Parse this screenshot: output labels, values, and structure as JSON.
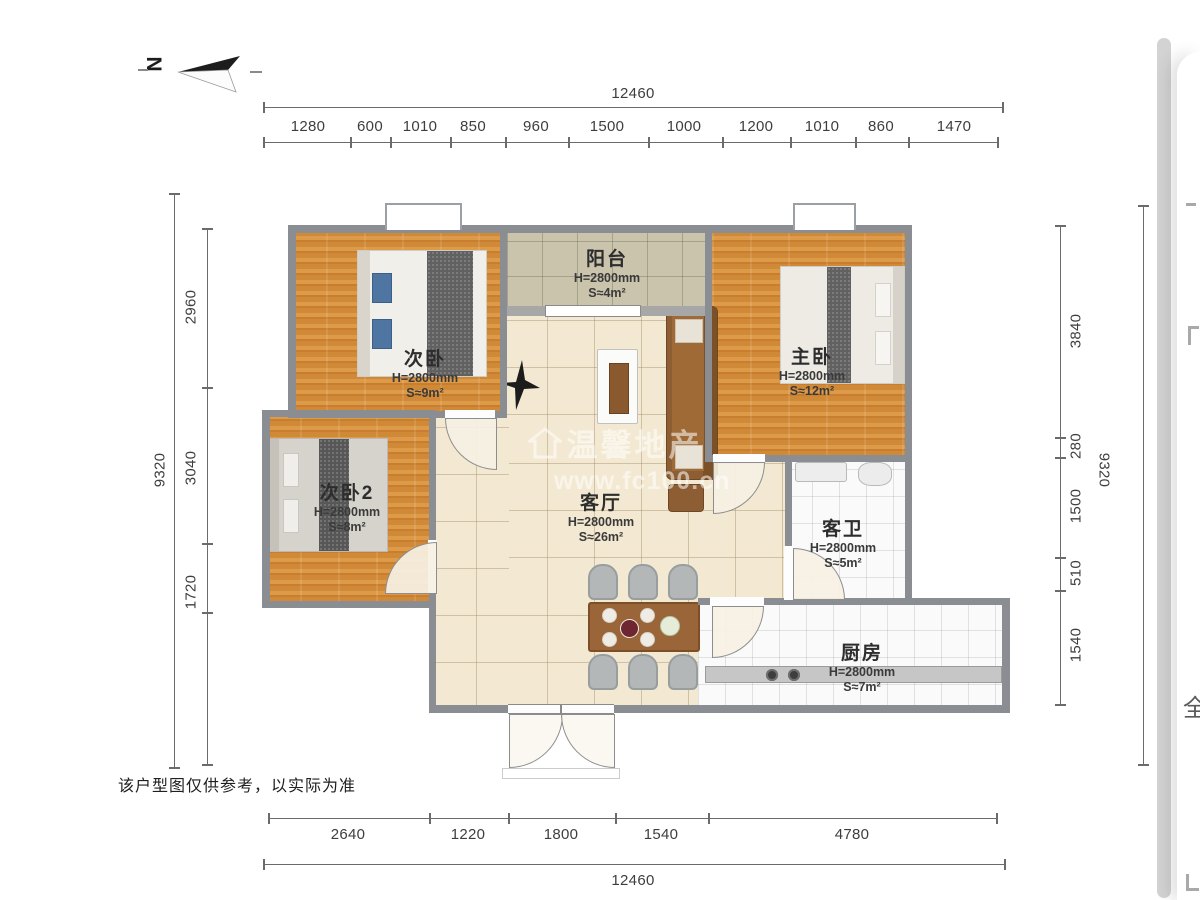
{
  "north": {
    "label": "N"
  },
  "dimensions": {
    "top": {
      "total": "12460",
      "segments": [
        "1280",
        "600",
        "1010",
        "850",
        "960",
        "1500",
        "1000",
        "1200",
        "1010",
        "860",
        "1470"
      ]
    },
    "bottom": {
      "total": "12460",
      "segments": [
        "2640",
        "1220",
        "1800",
        "1540",
        "4780"
      ]
    },
    "left": {
      "total": "9320",
      "segments": [
        "2960",
        "3040",
        "1720"
      ]
    },
    "right": {
      "total": "9320",
      "segments": [
        "3840",
        "280",
        "1500",
        "510",
        "1540"
      ]
    }
  },
  "rooms": [
    {
      "name": "阳台",
      "height": "H=2800mm",
      "area": "S≈4m²"
    },
    {
      "name": "次卧",
      "height": "H=2800mm",
      "area": "S≈9m²"
    },
    {
      "name": "主卧",
      "height": "H=2800mm",
      "area": "S≈12m²"
    },
    {
      "name": "次卧2",
      "height": "H=2800mm",
      "area": "S≈8m²"
    },
    {
      "name": "客厅",
      "height": "H=2800mm",
      "area": "S≈26m²"
    },
    {
      "name": "客卫",
      "height": "H=2800mm",
      "area": "S≈5m²"
    },
    {
      "name": "厨房",
      "height": "H=2800mm",
      "area": "S≈7m²"
    }
  ],
  "watermark": {
    "icon": "house-icon",
    "brand": "温馨地产",
    "url": "www.fc100.cn"
  },
  "disclaimer": "该户型图仅供参考，以实际为准",
  "side_panel": {
    "partial_char": "全"
  },
  "colors": {
    "wall": "#8a8e92",
    "wood_floor": "#d28a3c",
    "living_floor": "#f3e8d1",
    "balcony_floor": "#cac4ad",
    "wet_floor": "#fafafa",
    "dim_line": "#6b6b6b"
  }
}
